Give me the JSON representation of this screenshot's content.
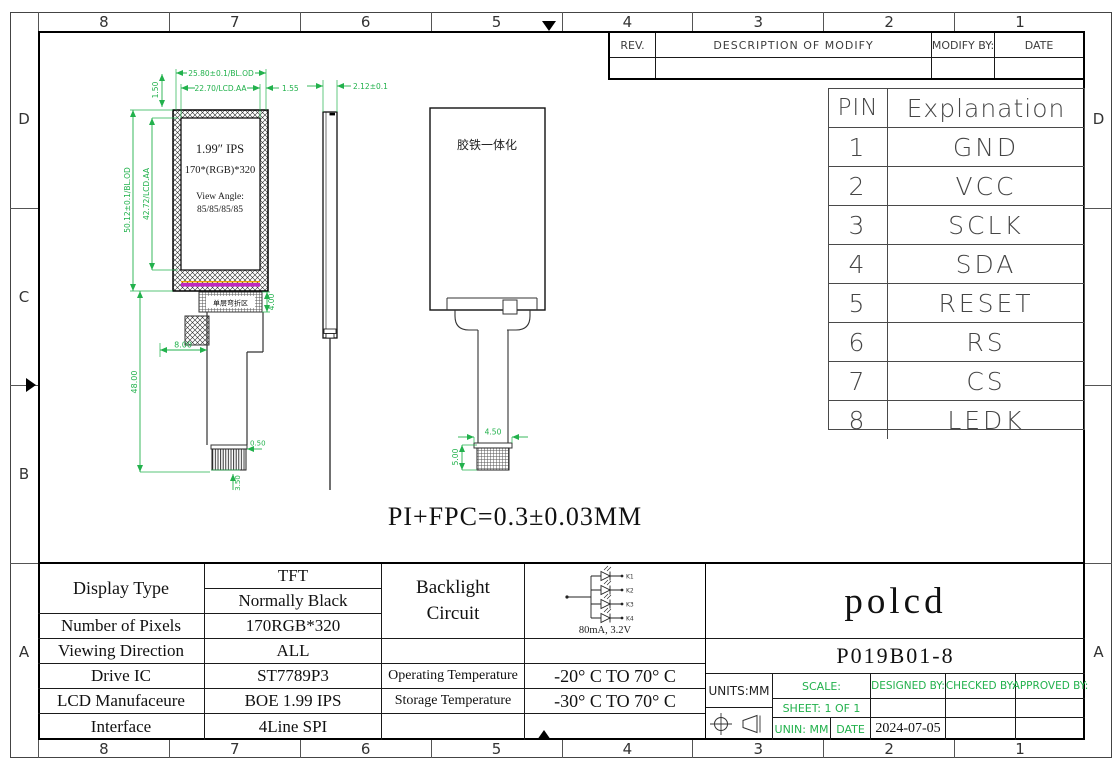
{
  "colors": {
    "dim_green": "#22b14c",
    "magenta": "#c02ac0",
    "line": "#1a1a1a"
  },
  "zones": {
    "columns": [
      "8",
      "7",
      "6",
      "5",
      "4",
      "3",
      "2",
      "1"
    ],
    "left": [
      "D",
      "C",
      "B",
      "A"
    ],
    "right_top": "D",
    "right_bottom": "A"
  },
  "revision": {
    "rev": "REV.",
    "description": "DESCRIPTION OF MODIFY",
    "modify_by": "MODIFY BY:",
    "date": "DATE"
  },
  "pin_table": {
    "header_pin": "PIN",
    "header_explanation": "Explanation",
    "rows": [
      {
        "no": "1",
        "signal": "GND"
      },
      {
        "no": "2",
        "signal": "VCC"
      },
      {
        "no": "3",
        "signal": "SCLK"
      },
      {
        "no": "4",
        "signal": "SDA"
      },
      {
        "no": "5",
        "signal": "RESET"
      },
      {
        "no": "6",
        "signal": "RS"
      },
      {
        "no": "7",
        "signal": "CS"
      },
      {
        "no": "8",
        "signal": "LEDK"
      }
    ]
  },
  "front_view": {
    "screen_line1": "1.99″ IPS",
    "screen_line2": "170*(RGB)*320",
    "screen_line3": "View Angle:",
    "screen_line4": "85/85/85/85",
    "bend_area_label": "单层弯折区",
    "dim_bl_width": "25.80±0.1/BL.OD",
    "dim_aa_width": "22.70/LCD.AA",
    "dim_right": "1.55",
    "dim_top": "1.50",
    "dim_bl_height": "50.12±0.1/BL.OD",
    "dim_aa_height": "42.72/LCD.AA",
    "dim_fpc_offset": "8.00",
    "dim_fpc_length": "48.00",
    "dim_bend": "4.00",
    "dim_conn_top": "0.50",
    "dim_conn_bottom": "3.50"
  },
  "side_view": {
    "dim_thickness": "2.12±0.1"
  },
  "back_view": {
    "label": "胶铁一体化",
    "dim_conn_width": "4.50",
    "dim_conn_height": "5.00"
  },
  "note": "PI+FPC=0.3±0.03MM",
  "spec": {
    "display_type_label": "Display Type",
    "display_type_value1": "TFT",
    "display_type_value2": "Normally Black",
    "rows": [
      {
        "label": "Number of Pixels",
        "value": "170RGB*320"
      },
      {
        "label": "Viewing Direction",
        "value": "ALL"
      },
      {
        "label": "Drive IC",
        "value": "ST7789P3"
      },
      {
        "label": "LCD Manufaceure",
        "value": "BOE 1.99 IPS"
      },
      {
        "label": "Interface",
        "value": "4Line SPI"
      }
    ]
  },
  "backlight": {
    "label_line1": "Backlight",
    "label_line2": "Circuit",
    "rating": "80mA, 3.2V",
    "led1": "K1",
    "led2": "K2",
    "led3": "K3",
    "led4": "K4"
  },
  "temperature": {
    "operating_label": "Operating Temperature",
    "operating_value": "-20° C TO 70° C",
    "storage_label": "Storage Temperature",
    "storage_value": "-30° C TO 70° C"
  },
  "title_block": {
    "brand": "polcd",
    "part_number": "P019B01-8",
    "units": "UNITS:MM",
    "scale_label": "SCALE:",
    "designed_label": "DESIGNED BY:",
    "checked_label": "CHECKED BY:",
    "approved_label": "APPROVED BY:",
    "sheet_label": "SHEET: 1 OF 1",
    "unin_label": "UNIN: MM",
    "date_label": "DATE",
    "date_value": "2024-07-05"
  }
}
